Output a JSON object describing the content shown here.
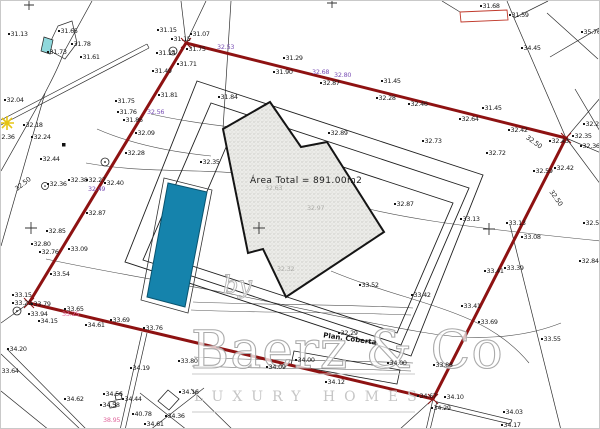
{
  "area_label": "Área Total  =  891.00m2",
  "building_label": "Plan. Coberta",
  "watermark": {
    "by": "by",
    "name": "Baerz & Co",
    "tagline": "LUXURY HOMES"
  },
  "colors": {
    "boundary_red": "#8e1212",
    "pool_blue": "#1583ac",
    "purple_label": "#7a4fb5",
    "pink_label": "#e0679c",
    "cyan_patch": "#8fd8dc",
    "yellow_star": "#e6c515"
  },
  "site": {
    "boundary": [
      [
        185,
        42
      ],
      [
        565,
        137
      ],
      [
        432,
        398
      ],
      [
        28,
        302
      ]
    ],
    "setbacks": [
      [
        [
          196,
          80
        ],
        [
          482,
          174
        ],
        [
          410,
          355
        ],
        [
          124,
          261
        ]
      ],
      [
        [
          210,
          102
        ],
        [
          468,
          187
        ],
        [
          400,
          344
        ],
        [
          142,
          259
        ]
      ],
      [
        [
          232,
          130
        ],
        [
          452,
          202
        ],
        [
          396,
          332
        ],
        [
          176,
          260
        ]
      ]
    ],
    "building": [
      [
        222,
        128
      ],
      [
        269,
        101
      ],
      [
        300,
        146
      ],
      [
        326,
        141
      ],
      [
        383,
        231
      ],
      [
        285,
        296
      ],
      [
        262,
        248
      ],
      [
        247,
        252
      ]
    ],
    "pool": [
      [
        167,
        182
      ],
      [
        206,
        191
      ],
      [
        184,
        306
      ],
      [
        146,
        296
      ]
    ],
    "pool_deck": [
      [
        163,
        177
      ],
      [
        211,
        189
      ],
      [
        187,
        312
      ],
      [
        140,
        299
      ]
    ],
    "coberta_box": [
      [
        293,
        350
      ],
      [
        399,
        369
      ],
      [
        396,
        383
      ],
      [
        290,
        364
      ]
    ],
    "red_marker_rect": [
      [
        459,
        11
      ],
      [
        506,
        9
      ],
      [
        507,
        19
      ],
      [
        460,
        21
      ]
    ],
    "cyan_patch": [
      [
        43,
        36
      ],
      [
        52,
        39
      ],
      [
        49,
        53
      ],
      [
        40,
        50
      ]
    ]
  },
  "labels": [
    {
      "x": 7,
      "y": 33,
      "t": "31.13"
    },
    {
      "x": 57,
      "y": 30,
      "t": "31.65"
    },
    {
      "x": 46,
      "y": 51,
      "t": "31.73"
    },
    {
      "x": 70,
      "y": 43,
      "t": "31.78"
    },
    {
      "x": 79,
      "y": 56,
      "t": "31.61"
    },
    {
      "x": 3,
      "y": 99,
      "t": "32.04"
    },
    {
      "x": 22,
      "y": 124,
      "t": "32.18"
    },
    {
      "x": -6,
      "y": 136,
      "t": "32.36"
    },
    {
      "x": 30,
      "y": 136,
      "t": "32.24"
    },
    {
      "x": 39,
      "y": 158,
      "t": "32.44"
    },
    {
      "x": 46,
      "y": 183,
      "t": "32.36"
    },
    {
      "x": 67,
      "y": 179,
      "t": "32.38"
    },
    {
      "x": 85,
      "y": 179,
      "t": "32.27"
    },
    {
      "x": 103,
      "y": 182,
      "t": "32.40"
    },
    {
      "x": 85,
      "y": 212,
      "t": "32.87"
    },
    {
      "x": 114,
      "y": 100,
      "t": "31.75"
    },
    {
      "x": 116,
      "y": 111,
      "t": "31.76"
    },
    {
      "x": 122,
      "y": 119,
      "t": "31.86"
    },
    {
      "x": 134,
      "y": 132,
      "t": "32.09"
    },
    {
      "x": 124,
      "y": 152,
      "t": "32.28"
    },
    {
      "x": 199,
      "y": 161,
      "t": "32.35"
    },
    {
      "x": 217,
      "y": 96,
      "t": "31.84"
    },
    {
      "x": 157,
      "y": 94,
      "t": "31.81"
    },
    {
      "x": 151,
      "y": 70,
      "t": "31.49"
    },
    {
      "x": 176,
      "y": 63,
      "t": "31.71"
    },
    {
      "x": 185,
      "y": 48,
      "t": "31.75"
    },
    {
      "x": 155,
      "y": 52,
      "t": "31.24"
    },
    {
      "x": 170,
      "y": 38,
      "t": "31.15"
    },
    {
      "x": 156,
      "y": 29,
      "t": "31.15"
    },
    {
      "x": 189,
      "y": 33,
      "t": "31.07"
    },
    {
      "x": 282,
      "y": 57,
      "t": "31.29"
    },
    {
      "x": 272,
      "y": 71,
      "t": "31.90"
    },
    {
      "x": 479,
      "y": 5,
      "t": "31.68"
    },
    {
      "x": 508,
      "y": 14,
      "t": "31.59"
    },
    {
      "x": 580,
      "y": 31,
      "t": "35.76"
    },
    {
      "x": 520,
      "y": 47,
      "t": "34.45"
    },
    {
      "x": 319,
      "y": 82,
      "t": "32.87"
    },
    {
      "x": 380,
      "y": 80,
      "t": "31.45"
    },
    {
      "x": 375,
      "y": 97,
      "t": "32.28"
    },
    {
      "x": 407,
      "y": 103,
      "t": "32.46"
    },
    {
      "x": 481,
      "y": 107,
      "t": "31.45"
    },
    {
      "x": 458,
      "y": 118,
      "t": "32.64"
    },
    {
      "x": 507,
      "y": 129,
      "t": "32.42"
    },
    {
      "x": 548,
      "y": 140,
      "t": "32.43"
    },
    {
      "x": 582,
      "y": 123,
      "t": "32.27"
    },
    {
      "x": 571,
      "y": 135,
      "t": "32.35"
    },
    {
      "x": 579,
      "y": 145,
      "t": "32.36"
    },
    {
      "x": 327,
      "y": 132,
      "t": "32.89"
    },
    {
      "x": 421,
      "y": 140,
      "t": "32.73"
    },
    {
      "x": 485,
      "y": 152,
      "t": "32.72"
    },
    {
      "x": 393,
      "y": 203,
      "t": "32.87"
    },
    {
      "x": 532,
      "y": 170,
      "t": "32.59"
    },
    {
      "x": 553,
      "y": 167,
      "t": "32.42"
    },
    {
      "x": 582,
      "y": 222,
      "t": "32.51"
    },
    {
      "x": 505,
      "y": 222,
      "t": "33.13"
    },
    {
      "x": 520,
      "y": 236,
      "t": "33.08"
    },
    {
      "x": 578,
      "y": 260,
      "t": "32.84"
    },
    {
      "x": 459,
      "y": 218,
      "t": "33.13"
    },
    {
      "x": 483,
      "y": 270,
      "t": "33.41"
    },
    {
      "x": 503,
      "y": 267,
      "t": "33.39"
    },
    {
      "x": 358,
      "y": 284,
      "t": "33.52"
    },
    {
      "x": 410,
      "y": 294,
      "t": "33.42"
    },
    {
      "x": 460,
      "y": 305,
      "t": "33.41"
    },
    {
      "x": 477,
      "y": 321,
      "t": "33.69"
    },
    {
      "x": 540,
      "y": 338,
      "t": "33.55"
    },
    {
      "x": 45,
      "y": 230,
      "t": "32.85"
    },
    {
      "x": 30,
      "y": 243,
      "t": "32.80"
    },
    {
      "x": 38,
      "y": 251,
      "t": "32.76"
    },
    {
      "x": 67,
      "y": 248,
      "t": "33.09"
    },
    {
      "x": 49,
      "y": 273,
      "t": "33.54"
    },
    {
      "x": 11,
      "y": 294,
      "t": "33.15"
    },
    {
      "x": 11,
      "y": 302,
      "t": "33.29"
    },
    {
      "x": 30,
      "y": 303,
      "t": "33.79"
    },
    {
      "x": 27,
      "y": 313,
      "t": "33.94"
    },
    {
      "x": 37,
      "y": 320,
      "t": "34.15"
    },
    {
      "x": 63,
      "y": 308,
      "t": "33.65"
    },
    {
      "x": 84,
      "y": 324,
      "t": "34.61"
    },
    {
      "x": 109,
      "y": 319,
      "t": "33.69"
    },
    {
      "x": 142,
      "y": 327,
      "t": "33.76"
    },
    {
      "x": 6,
      "y": 348,
      "t": "34.20"
    },
    {
      "x": -2,
      "y": 370,
      "t": "33.64"
    },
    {
      "x": 129,
      "y": 367,
      "t": "34.19"
    },
    {
      "x": 177,
      "y": 360,
      "t": "33.80"
    },
    {
      "x": 265,
      "y": 366,
      "t": "34.09"
    },
    {
      "x": 63,
      "y": 398,
      "t": "34.62"
    },
    {
      "x": 102,
      "y": 393,
      "t": "34.56"
    },
    {
      "x": 121,
      "y": 398,
      "t": "34.44"
    },
    {
      "x": 99,
      "y": 404,
      "t": "34.58"
    },
    {
      "x": 131,
      "y": 413,
      "t": "40.78"
    },
    {
      "x": 143,
      "y": 423,
      "t": "34.61"
    },
    {
      "x": 164,
      "y": 415,
      "t": "34.36"
    },
    {
      "x": 178,
      "y": 391,
      "t": "34.16"
    },
    {
      "x": 294,
      "y": 359,
      "t": "34.00"
    },
    {
      "x": 386,
      "y": 362,
      "t": "34.00"
    },
    {
      "x": 432,
      "y": 364,
      "t": "33.88"
    },
    {
      "x": 324,
      "y": 381,
      "t": "34.12"
    },
    {
      "x": 416,
      "y": 395,
      "t": "34.67"
    },
    {
      "x": 443,
      "y": 396,
      "t": "34.10"
    },
    {
      "x": 430,
      "y": 407,
      "t": "34.29"
    },
    {
      "x": 502,
      "y": 411,
      "t": "34.03"
    },
    {
      "x": 500,
      "y": 424,
      "t": "34.17"
    },
    {
      "x": 337,
      "y": 332,
      "t": "32.29"
    },
    {
      "x": 146,
      "y": 111,
      "t": "32.56",
      "c": "p"
    },
    {
      "x": 216,
      "y": 46,
      "t": "32.53",
      "c": "p"
    },
    {
      "x": 311,
      "y": 71,
      "t": "32.68",
      "c": "p"
    },
    {
      "x": 333,
      "y": 74,
      "t": "32.80",
      "c": "p"
    },
    {
      "x": 87,
      "y": 188,
      "t": "32.49",
      "c": "p"
    },
    {
      "x": 61,
      "y": 313,
      "t": "33.25",
      "c": "m"
    },
    {
      "x": 102,
      "y": 419,
      "t": "38.95",
      "c": "m"
    },
    {
      "x": 264,
      "y": 187,
      "t": "32.63",
      "c": "f"
    },
    {
      "x": 306,
      "y": 207,
      "t": "32.97",
      "c": "f"
    },
    {
      "x": 276,
      "y": 268,
      "t": "32.32",
      "c": "f"
    },
    {
      "x": 13,
      "y": 183,
      "t": "32.50",
      "c": "d",
      "r": -38
    },
    {
      "x": 524,
      "y": 141,
      "t": "32.50",
      "c": "d",
      "r": 36
    },
    {
      "x": 546,
      "y": 197,
      "t": "32.50",
      "c": "d",
      "r": 55
    }
  ]
}
